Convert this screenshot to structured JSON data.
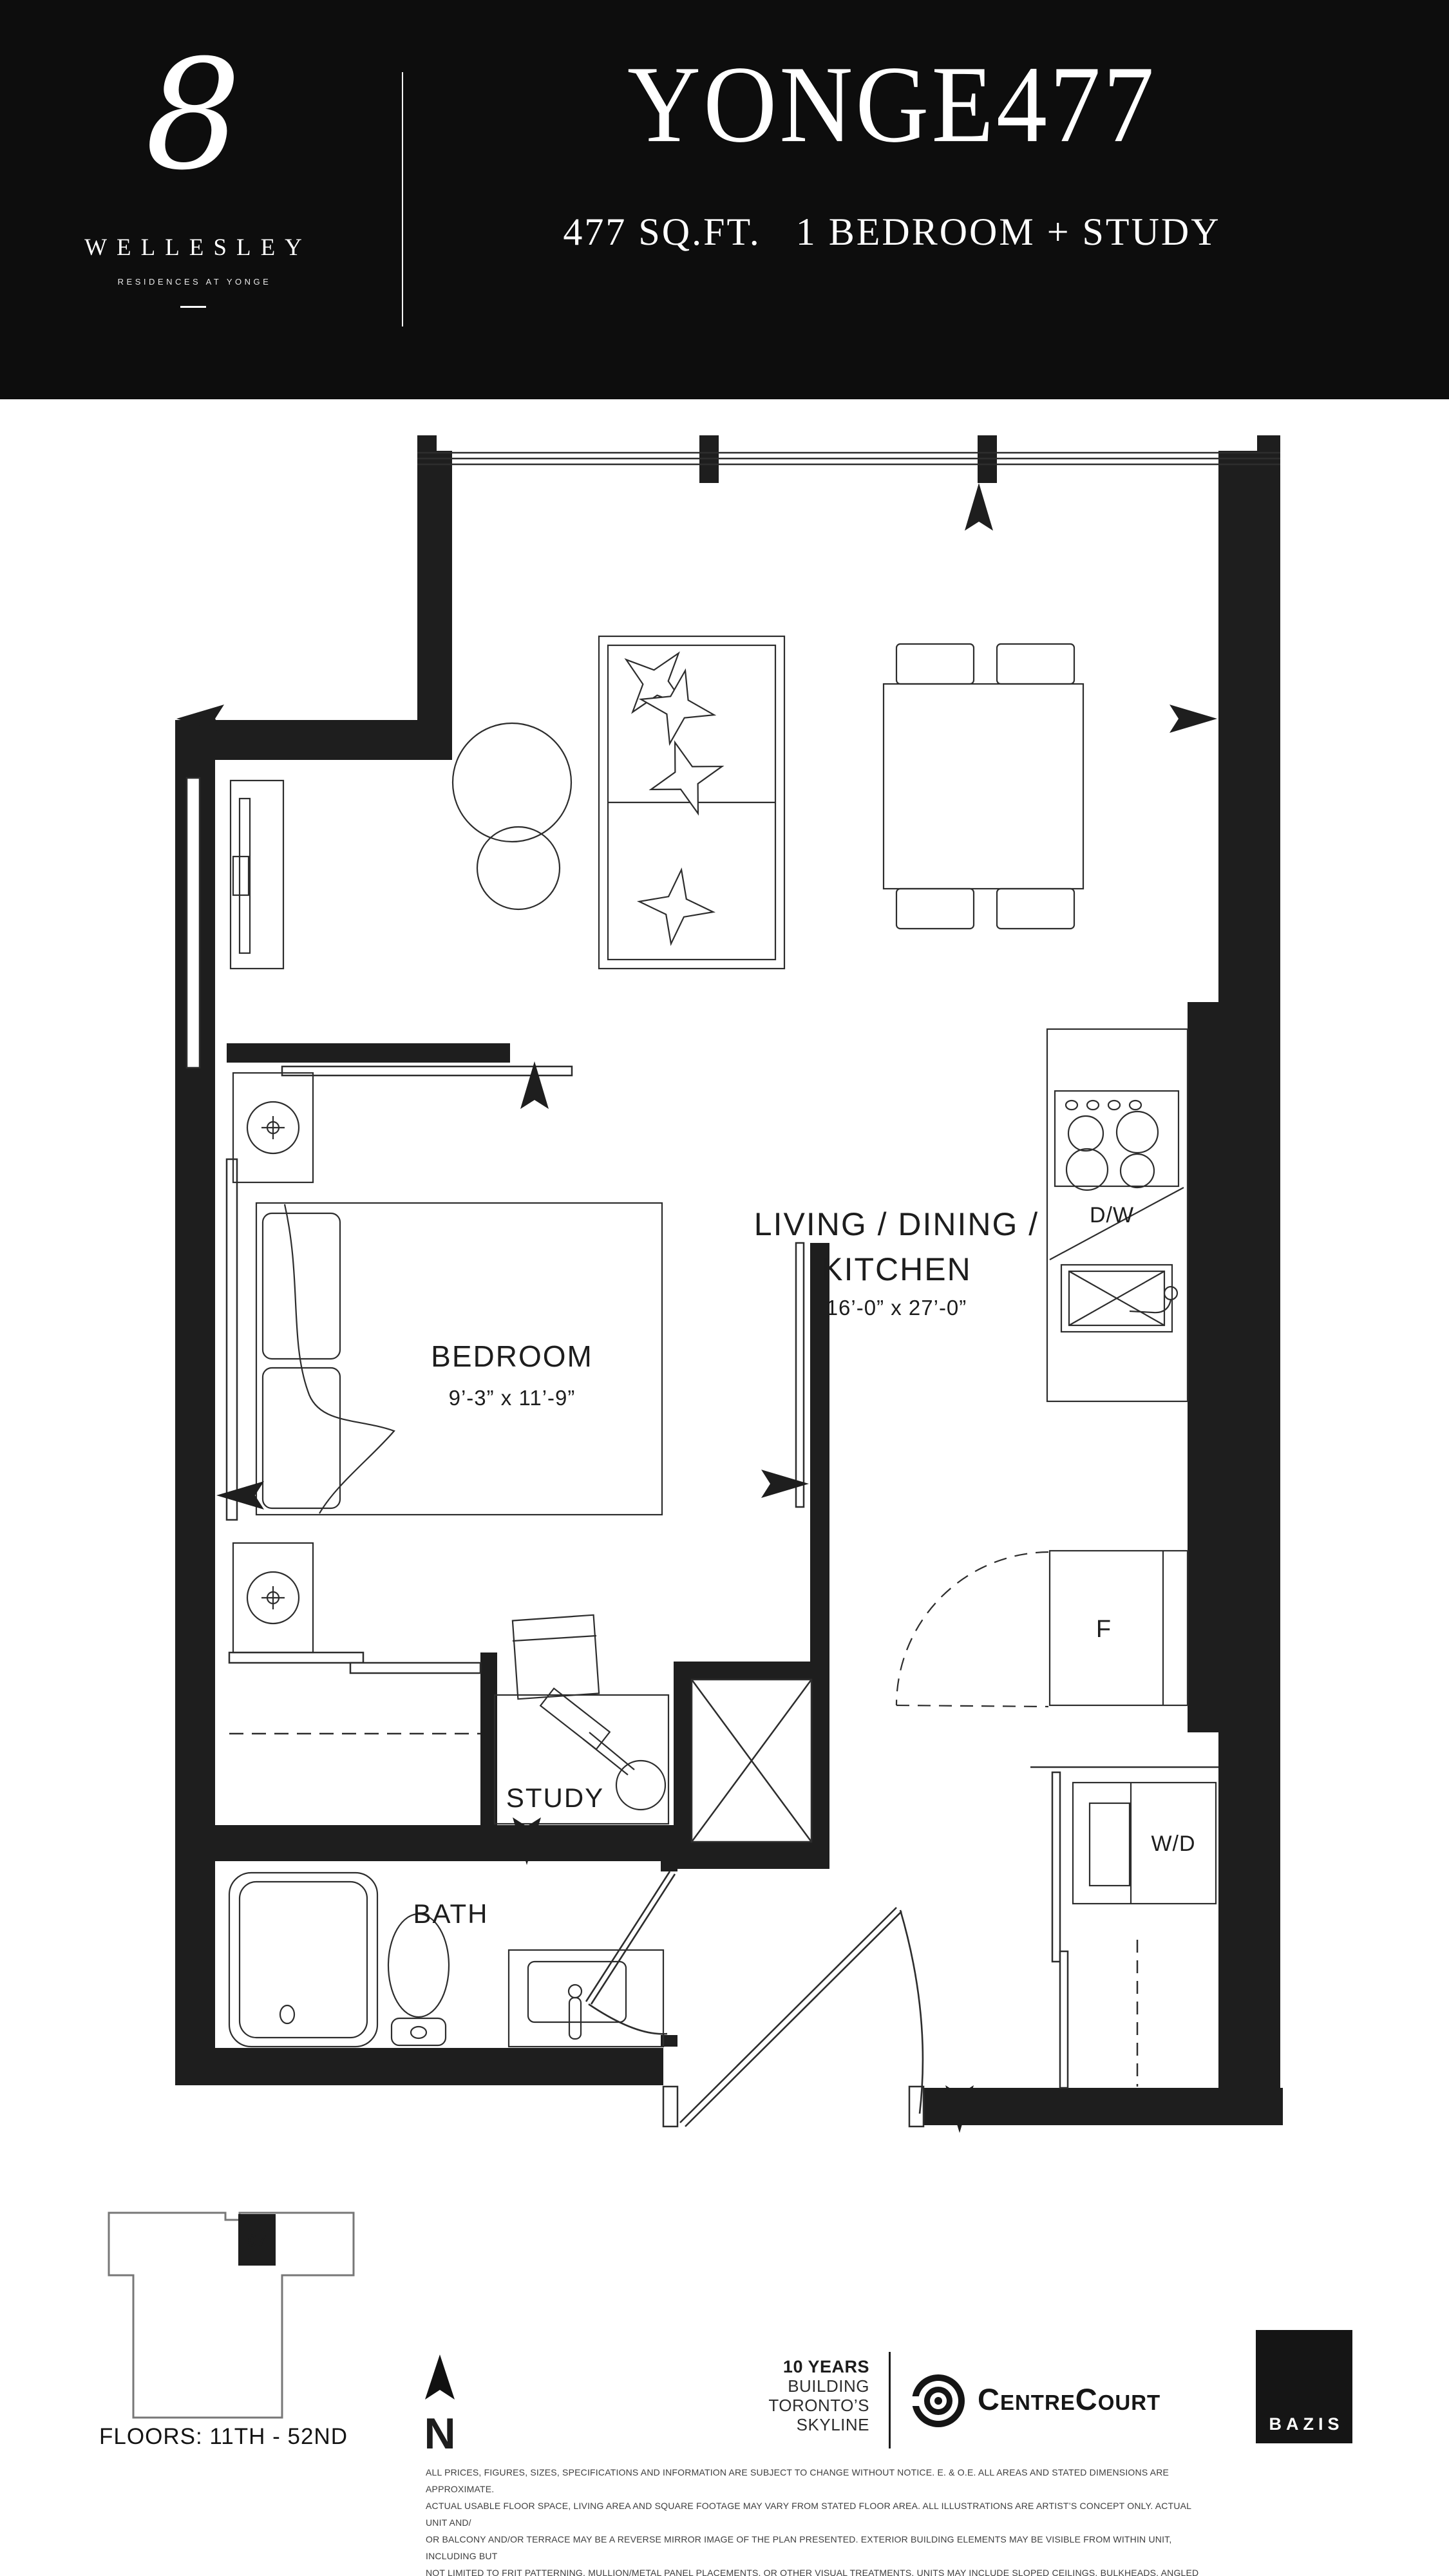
{
  "header": {
    "logo": {
      "numeral": "8",
      "name": "WELLESLEY",
      "tagline": "RESIDENCES AT YONGE"
    },
    "plan_name": "YONGE477",
    "plan_specs": "477 SQ.FT.   1 BEDROOM + STUDY",
    "colors": {
      "header_bg": "#0d0d0d",
      "header_text": "#ffffff"
    }
  },
  "floorplan": {
    "living": {
      "line1": "LIVING / DINING /",
      "line2": "KITCHEN",
      "dims": "16’-0” x 27’-0”"
    },
    "bedroom": {
      "name": "BEDROOM",
      "dims": "9’-3” x 11’-9”"
    },
    "study": {
      "name": "STUDY"
    },
    "bath": {
      "name": "BATH"
    },
    "kitchen": {
      "dishwasher": "D/W",
      "fridge": "F",
      "washer_dryer": "W/D"
    },
    "colors": {
      "walls": "#1e1e1e",
      "lines": "#2d2d2d"
    }
  },
  "keyplan": {
    "unit": "07",
    "floors_label": "FLOORS: 11TH - 52ND"
  },
  "compass": {
    "label": "N"
  },
  "branding": {
    "tagline_lines": [
      "10 YEARS",
      "BUILDING",
      "TORONTO’S",
      "SKYLINE"
    ],
    "developer_wordmark": "CentreCourt",
    "partner": "BAZIS"
  },
  "disclaimer": {
    "lines": [
      "ALL PRICES, FIGURES, SIZES, SPECIFICATIONS AND INFORMATION ARE SUBJECT TO CHANGE WITHOUT NOTICE. E. & O.E. ALL AREAS AND STATED DIMENSIONS ARE APPROXIMATE.",
      "ACTUAL USABLE FLOOR SPACE, LIVING AREA AND SQUARE FOOTAGE MAY VARY FROM STATED FLOOR AREA. ALL ILLUSTRATIONS ARE ARTIST’S CONCEPT ONLY. ACTUAL UNIT AND/",
      "OR BALCONY AND/OR TERRACE MAY BE A REVERSE MIRROR IMAGE OF THE PLAN PRESENTED. EXTERIOR BUILDING ELEMENTS MAY BE VISIBLE FROM WITHIN UNIT, INCLUDING BUT",
      "NOT LIMITED TO FRIT PATTERNING, MULLION/METAL PANEL PLACEMENTS, OR OTHER VISUAL TREATMENTS. UNITS MAY INCLUDE SLOPED CEILINGS, BULKHEADS, ANGLED WINDOWS",
      "AND/OR ANGLED COLUMNS. THE PURCHASE PRICE DOES NOT INCLUDE ANY FURNITURE. © 2020 CENTRECOURT DEVELOPMENTS. ALL RIGHTS RESERVED."
    ]
  }
}
